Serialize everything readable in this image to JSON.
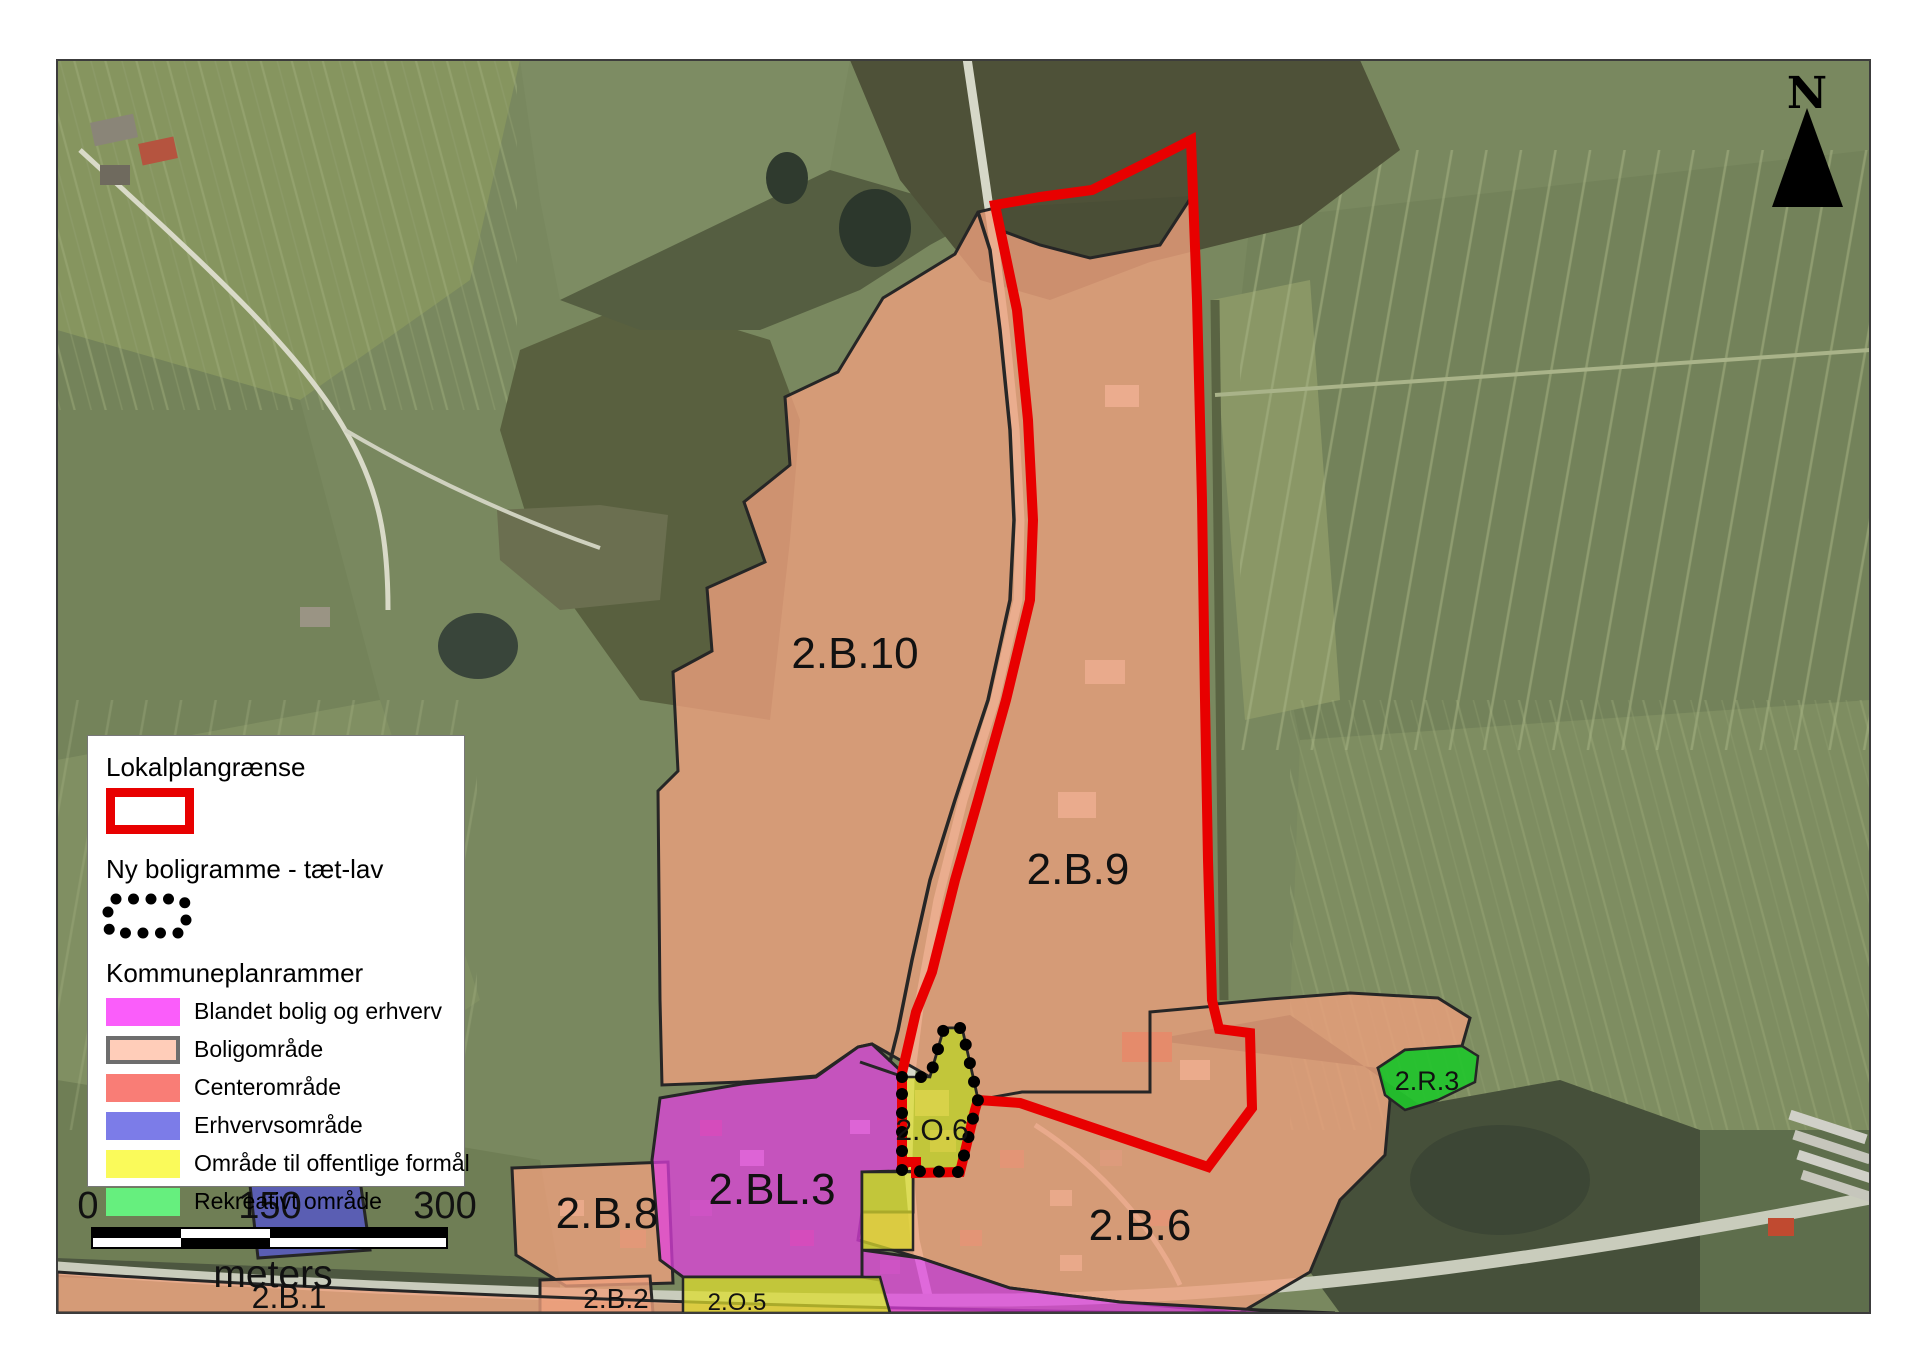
{
  "legend": {
    "lokalplan_title": "Lokalplangrænse",
    "boligramme_title": "Ny boligramme - tæt-lav",
    "kommuneplan_title": "Kommuneplanrammer",
    "items": [
      {
        "label": "Blandet bolig og erhverv",
        "color": "#fa5dfa"
      },
      {
        "label": "Boligområde",
        "color": "#ffcdb9"
      },
      {
        "label": "Centerområde",
        "color": "#f97d76"
      },
      {
        "label": "Erhvervsområde",
        "color": "#7c7ce8"
      },
      {
        "label": "Område til offentlige formål",
        "color": "#fafa5a"
      },
      {
        "label": "Rekreativt område",
        "color": "#66ef7e"
      }
    ]
  },
  "map": {
    "labels": {
      "b10": "2.B.10",
      "b9": "2.B.9",
      "b8": "2.B.8",
      "bl3": "2.BL.3",
      "b6": "2.B.6",
      "b2": "2.B.2",
      "b1": "2.B.1",
      "o5": "2.O.5",
      "o6": "2.O.6",
      "r3": "2.R.3"
    },
    "north": "N",
    "scale": {
      "t0": "0",
      "t150": "150",
      "t300": "300",
      "unit": "meters"
    }
  },
  "colors": {
    "lokalplan_red": "#e80000",
    "boligomraade": "#efa07e",
    "blandet": "#e23ee2",
    "offentlig": "#dede2c",
    "erhverv": "#5252d8",
    "rekreativ": "#1fc52b",
    "boundary": "#262626"
  }
}
